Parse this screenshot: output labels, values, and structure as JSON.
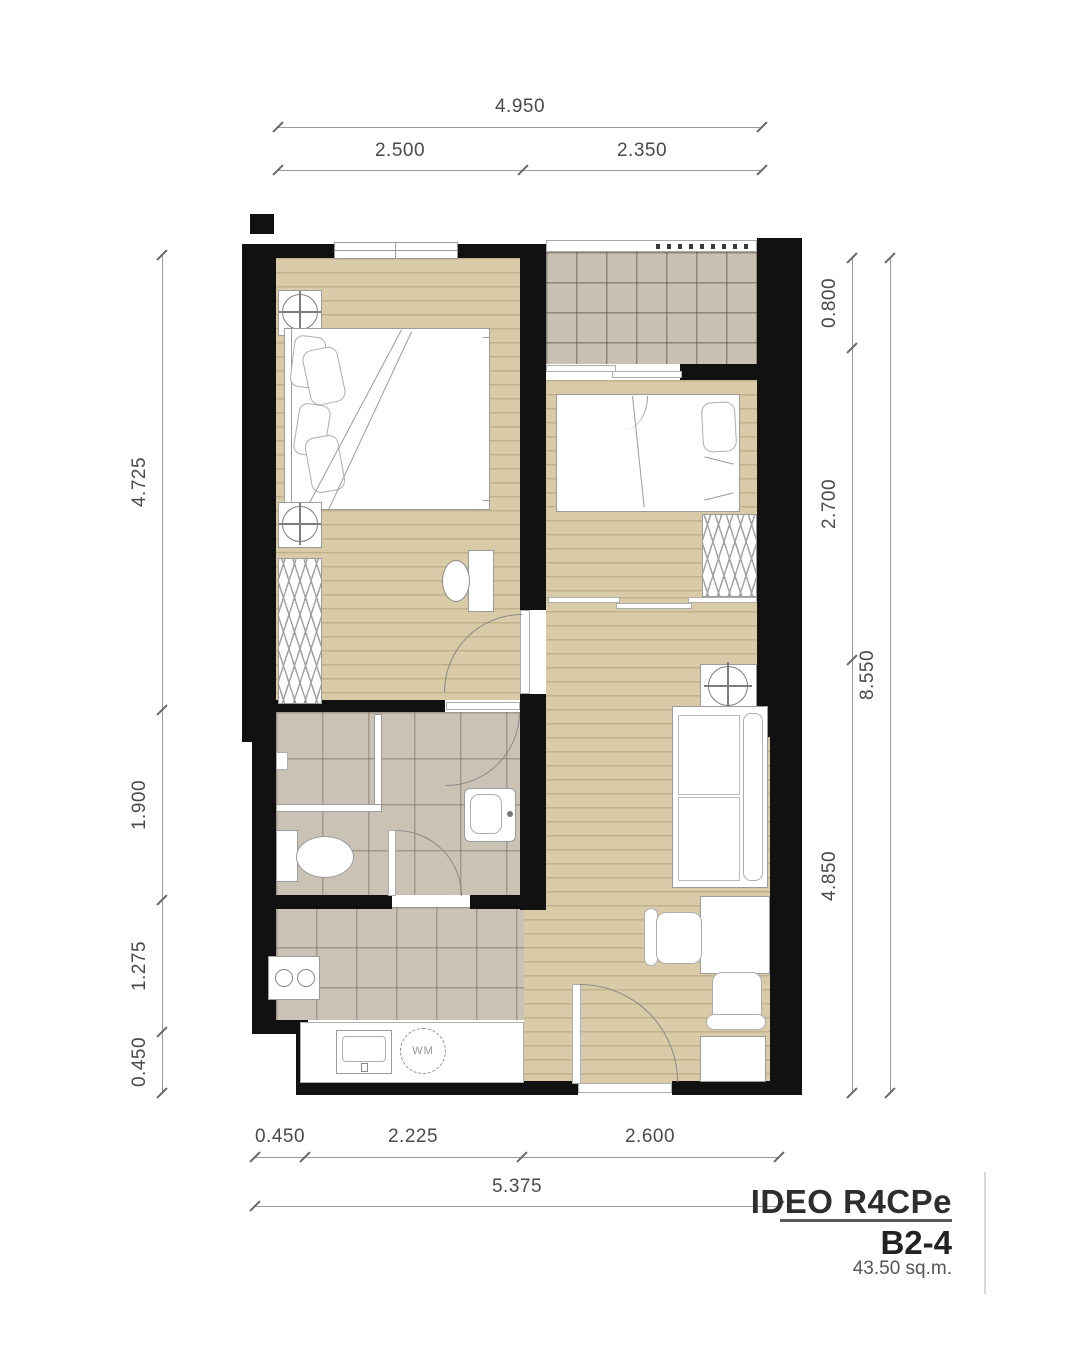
{
  "title_block": {
    "project": "IDEO R4CPe",
    "unit": "B2-4",
    "area": "43.50 sq.m."
  },
  "dimensions": {
    "top": {
      "total": "4.950",
      "segments": [
        "2.500",
        "2.350"
      ]
    },
    "bottom": {
      "total": "5.375",
      "segments": [
        "0.450",
        "2.225",
        "2.600"
      ]
    },
    "left": {
      "segments": [
        "4.725",
        "1.900",
        "1.275",
        "0.450"
      ]
    },
    "right": {
      "total": "8.550",
      "segments": [
        "0.800",
        "2.700",
        "4.850"
      ]
    }
  },
  "labels": {
    "washing_machine": "WM"
  },
  "colors": {
    "wall": "#111111",
    "wood_floor": "#d9cba7",
    "balcony_tile": "#c9c2b2",
    "bath_tile": "#cac3b5",
    "drawing_line": "#8a8a8a"
  }
}
